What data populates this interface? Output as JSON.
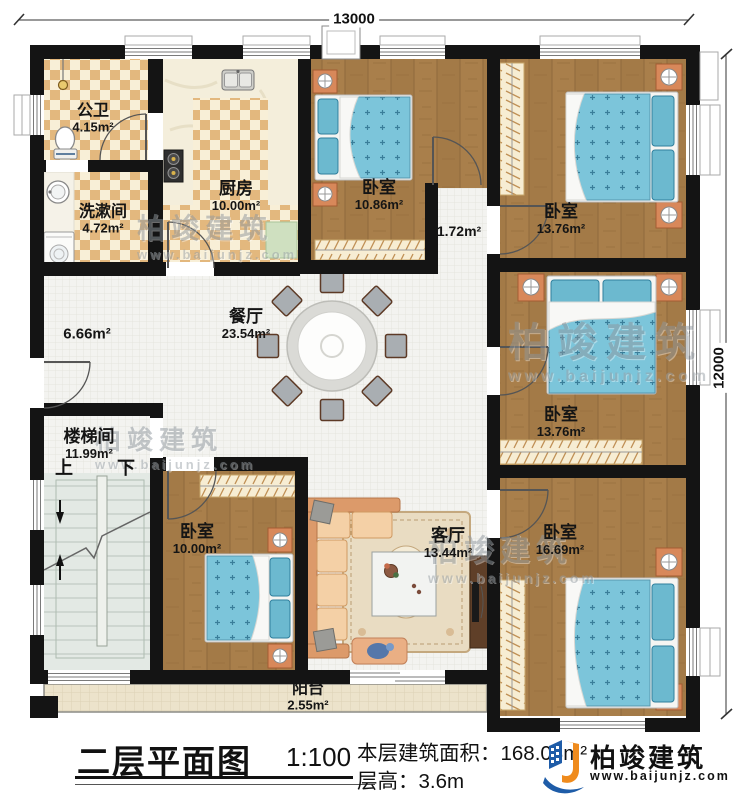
{
  "dimensions": {
    "width_top": "13000",
    "height_right": "12000"
  },
  "rooms": {
    "public_bath": {
      "name": "公卫",
      "area": "4.15m²"
    },
    "washroom": {
      "name": "洗漱间",
      "area": "4.72m²"
    },
    "kitchen": {
      "name": "厨房",
      "area": "10.00m²"
    },
    "bedroom_top_mid": {
      "name": "卧室",
      "area": "10.86m²"
    },
    "hallway_small": {
      "area": "1.72m²"
    },
    "bedroom_top_right": {
      "name": "卧室",
      "area": "13.76m²"
    },
    "bedroom_mid_right": {
      "name": "卧室",
      "area": "13.76m²"
    },
    "bedroom_bottom_right": {
      "name": "卧室",
      "area": "16.69m²"
    },
    "living_room": {
      "name": "客厅",
      "area": "13.44m²"
    },
    "bedroom_bottom_left": {
      "name": "卧室",
      "area": "10.00m²"
    },
    "stairwell": {
      "name": "楼梯间",
      "area": "11.99m²"
    },
    "dining_room": {
      "name": "餐厅",
      "area": "23.54m²"
    },
    "hall_open": {
      "area": "6.66m²"
    },
    "balcony": {
      "name": "阳台",
      "area": "2.55m²"
    }
  },
  "stairs": {
    "up_label": "上",
    "down_label": "下"
  },
  "title_block": {
    "title": "二层平面图",
    "scale": "1:100",
    "floor_area_label": "本层建筑面积：",
    "floor_area_value": "168.08m²",
    "floor_height_label": "层高：",
    "floor_height_value": "3.6m"
  },
  "brand": {
    "name": "柏竣建筑",
    "website": "www.baijunjz.com"
  },
  "watermark": {
    "name": "柏竣建筑",
    "website": "www.baijunjz.com"
  },
  "colors": {
    "wall": "#141414",
    "wood_floor": "#a97f4b",
    "bed_blue": "#7cc5da",
    "tile_tan": "#e3b87e",
    "brand_blue": "#1e5ca8",
    "brand_orange": "#ef8b1d"
  }
}
